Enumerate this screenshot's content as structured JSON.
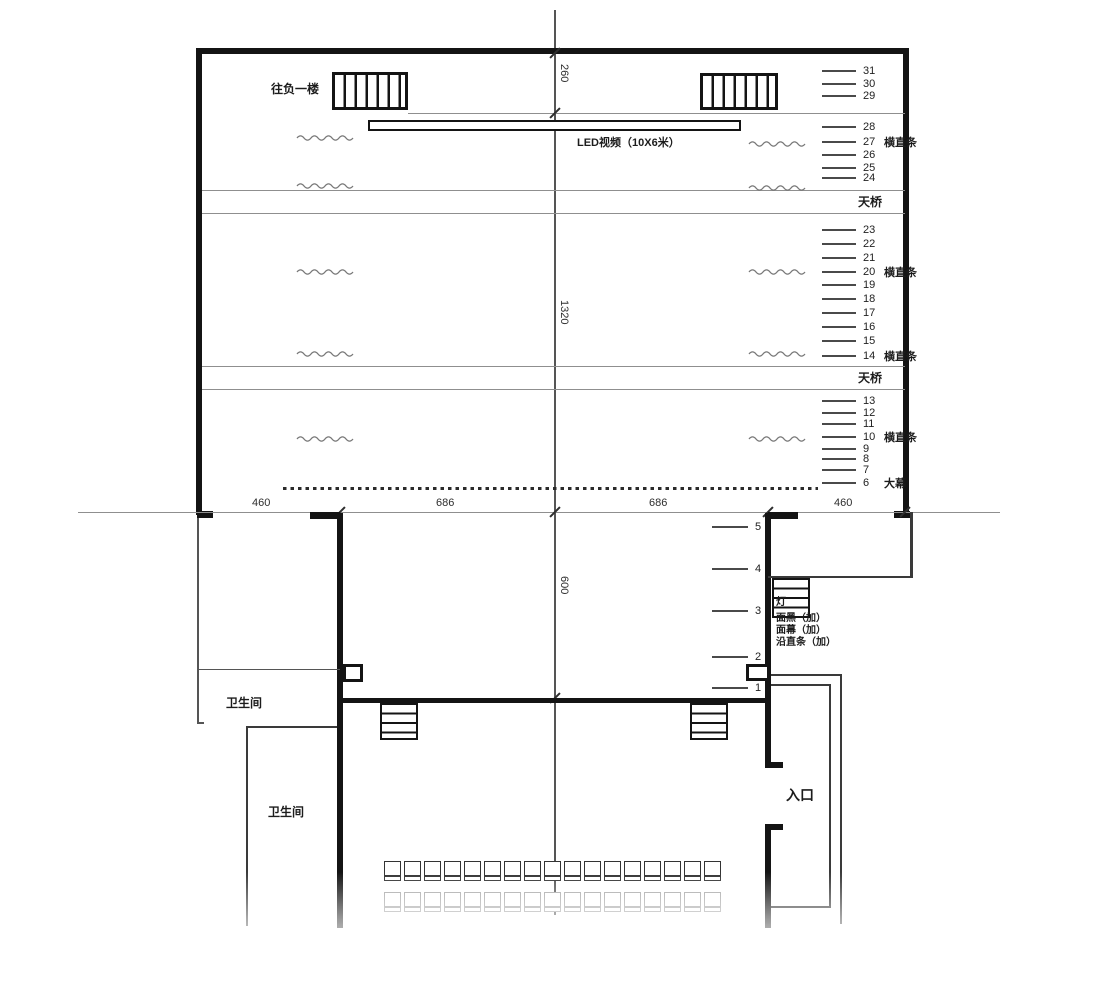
{
  "labels": {
    "to_basement": "往负一楼",
    "led_screen": "LED视频（10X6米）",
    "catwalk_upper": "天桥",
    "catwalk_lower": "天桥",
    "toilet_upper": "卫生间",
    "toilet_lower": "卫生间",
    "entrance": "入口",
    "stage_notes": [
      "灯",
      "面黑（加）",
      "面幕（加）",
      "沿直条（加）"
    ]
  },
  "dimensions": {
    "top_depth": "260",
    "main_depth": "1320",
    "apron_depth": "600",
    "widths": [
      "460",
      "686",
      "686",
      "460"
    ]
  },
  "battens": {
    "upper": [
      {
        "num": "31",
        "suffix": "",
        "y": 71
      },
      {
        "num": "30",
        "suffix": "",
        "y": 84
      },
      {
        "num": "29",
        "suffix": "",
        "y": 96
      },
      {
        "num": "28",
        "suffix": "",
        "y": 127
      },
      {
        "num": "27",
        "suffix": "横直条",
        "y": 142
      },
      {
        "num": "26",
        "suffix": "",
        "y": 155
      },
      {
        "num": "25",
        "suffix": "",
        "y": 168
      },
      {
        "num": "24",
        "suffix": "",
        "y": 178
      },
      {
        "num": "23",
        "suffix": "",
        "y": 230
      },
      {
        "num": "22",
        "suffix": "",
        "y": 244
      },
      {
        "num": "21",
        "suffix": "",
        "y": 258
      },
      {
        "num": "20",
        "suffix": "横直条",
        "y": 272
      },
      {
        "num": "19",
        "suffix": "",
        "y": 285
      },
      {
        "num": "18",
        "suffix": "",
        "y": 299
      },
      {
        "num": "17",
        "suffix": "",
        "y": 313
      },
      {
        "num": "16",
        "suffix": "",
        "y": 327
      },
      {
        "num": "15",
        "suffix": "",
        "y": 341
      },
      {
        "num": "14",
        "suffix": "横直条",
        "y": 356
      },
      {
        "num": "13",
        "suffix": "",
        "y": 401
      },
      {
        "num": "12",
        "suffix": "",
        "y": 413
      },
      {
        "num": "11",
        "suffix": "",
        "y": 424
      },
      {
        "num": "10",
        "suffix": "横直条",
        "y": 437
      },
      {
        "num": "9",
        "suffix": "",
        "y": 449
      },
      {
        "num": "8",
        "suffix": "",
        "y": 459
      },
      {
        "num": "7",
        "suffix": "",
        "y": 470
      },
      {
        "num": "6",
        "suffix": "大幕",
        "y": 483
      }
    ],
    "lower": [
      {
        "num": "5",
        "suffix": "",
        "y": 527
      },
      {
        "num": "4",
        "suffix": "",
        "y": 569
      },
      {
        "num": "3",
        "suffix": "",
        "y": 611
      },
      {
        "num": "2",
        "suffix": "",
        "y": 657
      },
      {
        "num": "1",
        "suffix": "",
        "y": 688
      }
    ]
  },
  "seating": {
    "rows": 2,
    "seats_per_row": 17
  },
  "squiggle_marks": [
    {
      "x": 296,
      "y": 133
    },
    {
      "x": 748,
      "y": 139
    },
    {
      "x": 296,
      "y": 181
    },
    {
      "x": 748,
      "y": 183
    },
    {
      "x": 296,
      "y": 267
    },
    {
      "x": 748,
      "y": 267
    },
    {
      "x": 296,
      "y": 349
    },
    {
      "x": 748,
      "y": 349
    },
    {
      "x": 296,
      "y": 434
    },
    {
      "x": 748,
      "y": 434
    }
  ],
  "colors": {
    "ink": "#141414",
    "thin_line": "#8f8f8f",
    "squiggle": "#777777"
  }
}
